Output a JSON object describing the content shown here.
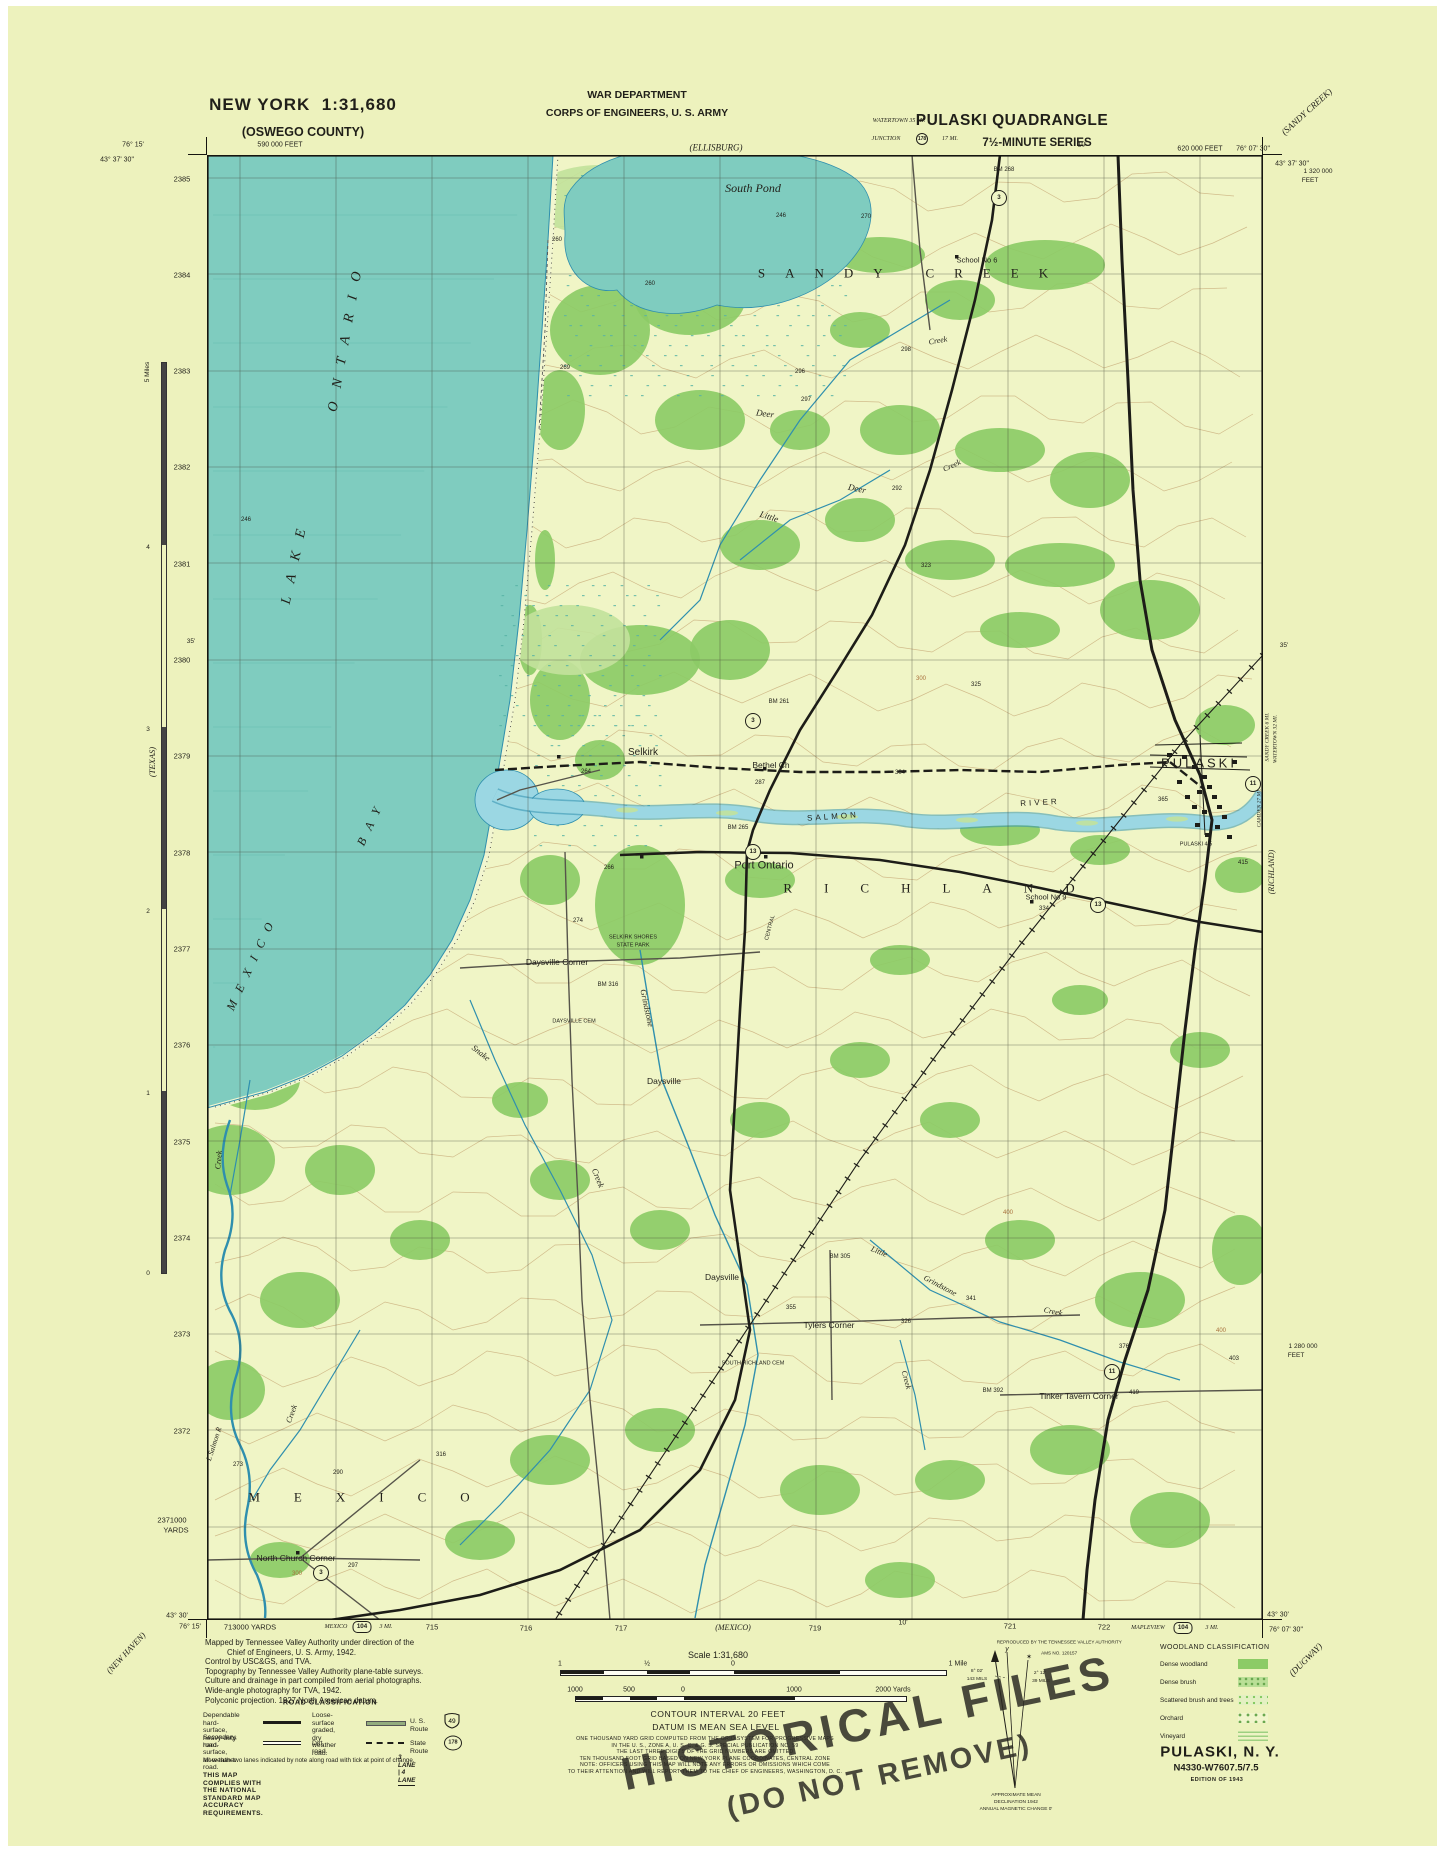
{
  "colors": {
    "paper": "#edf2bd",
    "land": "#f0f5c6",
    "lake": "#7fccbf",
    "water_line": "#2f8fae",
    "river": "#9bd7e3",
    "woodland": "#8ccb66",
    "woodland_light": "#c2e29b",
    "contour": "#a8703c",
    "road": "#1d1d18",
    "secondary_road": "#56544a",
    "grid": "#3c3c30",
    "text": "#201f19",
    "stamp": "#2a2821"
  },
  "header": {
    "state_scale": "NEW YORK  1:31,680",
    "county": "(OSWEGO COUNTY)",
    "dept1": "WAR DEPARTMENT",
    "dept2": "CORPS OF ENGINEERS, U. S. ARMY",
    "quad": "PULASKI QUADRANGLE",
    "series": "7½-MINUTE SERIES"
  },
  "credits": {
    "lines": [
      "Mapped by Tennessee Valley Authority under direction of the",
      "Chief of Engineers, U. S. Army, 1942.",
      "Control by USC&GS, and TVA.",
      "Topography by Tennessee Valley Authority plane-table surveys.",
      "Culture and drainage in part compiled from aerial photographs.",
      "Wide-angle photography for TVA, 1942.",
      "Polyconic projection. 1927 North American datum."
    ]
  },
  "road_class": {
    "title": "ROAD CLASSIFICATION",
    "r1a": "Dependable hard-surface,",
    "r1b": "heavy-duty road.",
    "r2a": "Loose-surface graded,",
    "r2b": "dry weather road.",
    "us_route": "U. S. Route",
    "us_num": "49",
    "r3a": "Secondary, hard-surface,",
    "r3b": "all-weather road.",
    "dirt": "Dirt road.",
    "state_route": "State Route",
    "state_num": "178",
    "note": "More than two lanes indicated by note along road with tick at point of change.",
    "lanes": "3 LANE | 4 LANE",
    "accuracy": "THIS MAP COMPLIES WITH THE NATIONAL STANDARD MAP ACCURACY REQUIREMENTS."
  },
  "scale_block": {
    "scale_label": "Scale 1:31,680",
    "mile_labels": [
      "1",
      "½",
      "0",
      "1 Mile"
    ],
    "yard_labels": [
      "1000",
      "500",
      "0",
      "1000",
      "2000 Yards"
    ],
    "contour": "CONTOUR INTERVAL 20 FEET",
    "datum": "DATUM IS MEAN SEA LEVEL",
    "fine": [
      "ONE THOUSAND YARD GRID COMPUTED FROM THE GRID SYSTEM FOR PROGRESSIVE MAPS",
      "IN THE U. S., ZONE A, U. S. C. & G. S. SPECIAL PUBLICATION NO. 59",
      "THE LAST THREE DIGITS OF THE GRID NUMBERS ARE OMITTED",
      "TEN THOUSAND FOOT GRID BASED ON NEW YORK PLANE COORDINATES, CENTRAL ZONE",
      "NOTE: OFFICERS USING THIS MAP WILL NOTE ANY ERRORS OR OMISSIONS WHICH COME",
      "TO THEIR ATTENTION AND WILL REPORT THEM TO THE CHIEF OF ENGINEERS, WASHINGTON, D. C."
    ]
  },
  "repro": {
    "l1": "REPRODUCED BY THE TENNESSEE VALLEY AUTHORITY",
    "l2": "AMS NO. 120157"
  },
  "declination": {
    "y": "y",
    "star": "✶",
    "left_deg": "8° 02'",
    "left_mils": "143 MILS",
    "right_deg": "2° 12'",
    "right_mils": "39 MILS",
    "note1": "APPROXIMATE MEAN",
    "note2": "DECLINATION 1942",
    "note3": "ANNUAL MAGNETIC CHANGE 0'"
  },
  "woodland": {
    "title": "WOODLAND CLASSIFICATION",
    "items": [
      {
        "label": "Dense woodland",
        "swatch": "dense"
      },
      {
        "label": "Dense brush",
        "swatch": "brush"
      },
      {
        "label": "Scattered brush and trees",
        "swatch": "scattered"
      },
      {
        "label": "Orchard",
        "swatch": "orchard"
      },
      {
        "label": "Vineyard",
        "swatch": "vineyard"
      }
    ]
  },
  "edition": {
    "title": "PULASKI, N. Y.",
    "code": "N4330-W7607.5/7.5",
    "ed": "EDITION OF 1943"
  },
  "stamp": {
    "l1": "HISTORICAL FILES",
    "l2": "(DO NOT REMOVE)"
  },
  "grid": {
    "xs": [
      240,
      336,
      432,
      528,
      624,
      720,
      816,
      912,
      1008,
      1104,
      1200
    ],
    "ys": [
      178,
      274,
      371,
      467,
      563,
      660,
      756,
      852,
      949,
      1045,
      1141,
      1238,
      1334,
      1430,
      1527
    ]
  },
  "route_shields": [
    {
      "n": "3",
      "x": 999,
      "y": 198
    },
    {
      "n": "3",
      "x": 753,
      "y": 721
    },
    {
      "n": "3",
      "x": 321,
      "y": 1573
    },
    {
      "n": "11",
      "x": 1253,
      "y": 784
    },
    {
      "n": "11",
      "x": 1112,
      "y": 1372
    },
    {
      "n": "13",
      "x": 753,
      "y": 852
    },
    {
      "n": "13",
      "x": 1098,
      "y": 905
    },
    {
      "n": "178",
      "x": 922,
      "y": 139,
      "sm": 1
    },
    {
      "n": "104",
      "x": 362,
      "y": 1627,
      "k": "b"
    },
    {
      "n": "104",
      "x": 1183,
      "y": 1628,
      "k": "b"
    }
  ],
  "map_labels": [
    {
      "t": "43° 37' 30\"",
      "x": 117,
      "y": 160,
      "s": 7
    },
    {
      "t": "76° 15'",
      "x": 133,
      "y": 145,
      "s": 7
    },
    {
      "t": "590 000 FEET",
      "x": 280,
      "y": 145,
      "s": 7
    },
    {
      "t": "(ELLISBURG)",
      "x": 716,
      "y": 148,
      "s": 9,
      "c": "i"
    },
    {
      "t": "10'",
      "x": 1082,
      "y": 145,
      "s": 7
    },
    {
      "t": "WATERTOWN 35 MI.",
      "x": 899,
      "y": 121,
      "s": 6,
      "c": "i"
    },
    {
      "t": "JUNCTION",
      "x": 886,
      "y": 139,
      "s": 6,
      "c": "i"
    },
    {
      "t": "17 MI.",
      "x": 950,
      "y": 139,
      "s": 6,
      "c": "i"
    },
    {
      "t": "620 000 FEET",
      "x": 1200,
      "y": 149,
      "s": 7
    },
    {
      "t": "76° 07' 30\"",
      "x": 1253,
      "y": 149,
      "s": 7
    },
    {
      "t": "43° 37' 30\"",
      "x": 1292,
      "y": 164,
      "s": 7
    },
    {
      "t": "(SANDY CREEK)",
      "x": 1307,
      "y": 112,
      "s": 9,
      "c": "i",
      "r": -42
    },
    {
      "t": "1 320 000",
      "x": 1318,
      "y": 172,
      "s": 6.5
    },
    {
      "t": "FEET",
      "x": 1310,
      "y": 181,
      "s": 6.5
    },
    {
      "t": "2385",
      "x": 182,
      "y": 179,
      "s": 7.5
    },
    {
      "t": "2384",
      "x": 182,
      "y": 275,
      "s": 7.5
    },
    {
      "t": "2383",
      "x": 182,
      "y": 371,
      "s": 7.5
    },
    {
      "t": "2382",
      "x": 182,
      "y": 467,
      "s": 7.5
    },
    {
      "t": "2381",
      "x": 182,
      "y": 564,
      "s": 7.5
    },
    {
      "t": "2380",
      "x": 182,
      "y": 660,
      "s": 7.5
    },
    {
      "t": "2379",
      "x": 182,
      "y": 756,
      "s": 7.5
    },
    {
      "t": "2378",
      "x": 182,
      "y": 853,
      "s": 7.5
    },
    {
      "t": "2377",
      "x": 182,
      "y": 949,
      "s": 7.5
    },
    {
      "t": "2376",
      "x": 182,
      "y": 1045,
      "s": 7.5
    },
    {
      "t": "2375",
      "x": 182,
      "y": 1142,
      "s": 7.5
    },
    {
      "t": "2374",
      "x": 182,
      "y": 1238,
      "s": 7.5
    },
    {
      "t": "2373",
      "x": 182,
      "y": 1334,
      "s": 7.5
    },
    {
      "t": "2372",
      "x": 182,
      "y": 1431,
      "s": 7.5
    },
    {
      "t": "2371000",
      "x": 172,
      "y": 1520,
      "s": 7.5
    },
    {
      "t": "YARDS",
      "x": 176,
      "y": 1530,
      "s": 7.5
    },
    {
      "t": "35'",
      "x": 191,
      "y": 642,
      "s": 6.5
    },
    {
      "t": "35'",
      "x": 1284,
      "y": 646,
      "s": 6.5
    },
    {
      "t": "1 280 000",
      "x": 1303,
      "y": 1347,
      "s": 6.5
    },
    {
      "t": "FEET",
      "x": 1296,
      "y": 1356,
      "s": 6.5
    },
    {
      "t": "5 Miles",
      "x": 148,
      "y": 372,
      "s": 6.5,
      "r": -90
    },
    {
      "t": "4",
      "x": 148,
      "y": 548,
      "s": 6.5
    },
    {
      "t": "3",
      "x": 148,
      "y": 730,
      "s": 6.5
    },
    {
      "t": "2",
      "x": 148,
      "y": 912,
      "s": 6.5
    },
    {
      "t": "1",
      "x": 148,
      "y": 1094,
      "s": 6.5
    },
    {
      "t": "0",
      "x": 148,
      "y": 1274,
      "s": 6.5
    },
    {
      "t": "(TEXAS)",
      "x": 152,
      "y": 762,
      "s": 8.5,
      "c": "i",
      "r": -90
    },
    {
      "t": "(NEW HAVEN)",
      "x": 126,
      "y": 1653,
      "s": 8.5,
      "c": "i",
      "r": -47
    },
    {
      "t": "SANDY CREEK 6 MI.",
      "x": 1268,
      "y": 737,
      "s": 5.5,
      "c": "i",
      "r": -90
    },
    {
      "t": "WATERTOWN 32 MI.",
      "x": 1276,
      "y": 739,
      "s": 5.5,
      "c": "i",
      "r": -90
    },
    {
      "t": "CAMDEN 27 MI.",
      "x": 1260,
      "y": 808,
      "s": 5.5,
      "c": "i",
      "r": -90
    },
    {
      "t": "(RICHLAND)",
      "x": 1272,
      "y": 872,
      "s": 8,
      "c": "i",
      "r": -90
    },
    {
      "t": "43° 30'",
      "x": 177,
      "y": 1616,
      "s": 7
    },
    {
      "t": "76° 15'",
      "x": 190,
      "y": 1627,
      "s": 7
    },
    {
      "t": "713000 YARDS",
      "x": 250,
      "y": 1627,
      "s": 7.5
    },
    {
      "t": "MEXICO",
      "x": 336,
      "y": 1627,
      "s": 6,
      "c": "i"
    },
    {
      "t": "3 MI.",
      "x": 386,
      "y": 1627,
      "s": 6,
      "c": "i"
    },
    {
      "t": "715",
      "x": 432,
      "y": 1627,
      "s": 7.5
    },
    {
      "t": "716",
      "x": 526,
      "y": 1628,
      "s": 7.5
    },
    {
      "t": "717",
      "x": 621,
      "y": 1628,
      "s": 7.5
    },
    {
      "t": "(MEXICO)",
      "x": 733,
      "y": 1628,
      "s": 8,
      "c": "i"
    },
    {
      "t": "719",
      "x": 815,
      "y": 1628,
      "s": 7.5
    },
    {
      "t": "10'",
      "x": 903,
      "y": 1623,
      "s": 7
    },
    {
      "t": "721",
      "x": 1010,
      "y": 1626,
      "s": 7.5
    },
    {
      "t": "722",
      "x": 1104,
      "y": 1627,
      "s": 7.5
    },
    {
      "t": "MAPLEVIEW",
      "x": 1148,
      "y": 1628,
      "s": 6,
      "c": "i"
    },
    {
      "t": "3 MI.",
      "x": 1212,
      "y": 1628,
      "s": 6,
      "c": "i"
    },
    {
      "t": "43° 30'",
      "x": 1278,
      "y": 1615,
      "s": 7
    },
    {
      "t": "76° 07' 30\"",
      "x": 1286,
      "y": 1630,
      "s": 7
    },
    {
      "t": "(DUGWAY)",
      "x": 1306,
      "y": 1660,
      "s": 9,
      "c": "i",
      "r": -45
    },
    {
      "t": "South Pond",
      "x": 753,
      "y": 188,
      "s": 12,
      "c": "i"
    },
    {
      "t": "246",
      "x": 781,
      "y": 216,
      "s": 6
    },
    {
      "t": "270",
      "x": 866,
      "y": 217,
      "s": 6
    },
    {
      "t": "260",
      "x": 650,
      "y": 284,
      "s": 6
    },
    {
      "t": "BM 268",
      "x": 1004,
      "y": 170,
      "s": 6
    },
    {
      "t": "SANDY CREEK",
      "x": 913,
      "y": 273,
      "s": 13,
      "c": "ser",
      "ls": 20
    },
    {
      "t": "School No 6",
      "x": 977,
      "y": 260,
      "s": 7.5
    },
    {
      "t": "Creek",
      "x": 938,
      "y": 341,
      "s": 8,
      "c": "i",
      "r": -10
    },
    {
      "t": "298",
      "x": 906,
      "y": 350,
      "s": 6
    },
    {
      "t": "Deer",
      "x": 765,
      "y": 414,
      "s": 9,
      "c": "i",
      "r": 8
    },
    {
      "t": "296",
      "x": 800,
      "y": 372,
      "s": 6
    },
    {
      "t": "Creek",
      "x": 952,
      "y": 466,
      "s": 8,
      "c": "i",
      "r": -25
    },
    {
      "t": "Deer",
      "x": 857,
      "y": 489,
      "s": 9,
      "c": "i",
      "r": 12
    },
    {
      "t": "297",
      "x": 806,
      "y": 400,
      "s": 6
    },
    {
      "t": "Little",
      "x": 769,
      "y": 517,
      "s": 9,
      "c": "i",
      "r": 18
    },
    {
      "t": "292",
      "x": 897,
      "y": 489,
      "s": 6
    },
    {
      "t": "323",
      "x": 926,
      "y": 566,
      "s": 6
    },
    {
      "t": "246",
      "x": 246,
      "y": 520,
      "s": 6
    },
    {
      "t": "269",
      "x": 565,
      "y": 368,
      "s": 6
    },
    {
      "t": "260",
      "x": 557,
      "y": 240,
      "s": 6
    },
    {
      "t": "LAKE",
      "x": 296,
      "y": 560,
      "s": 14,
      "c": "i",
      "r": -78,
      "ls": 14
    },
    {
      "t": "ONTARIO",
      "x": 347,
      "y": 335,
      "s": 14,
      "c": "i",
      "r": -80,
      "ls": 14
    },
    {
      "t": "MEXICO",
      "x": 252,
      "y": 962,
      "s": 12,
      "c": "i",
      "r": -65,
      "ls": 10
    },
    {
      "t": "BAY",
      "x": 371,
      "y": 822,
      "s": 12,
      "c": "i",
      "r": -65,
      "ls": 10
    },
    {
      "t": "BM 261",
      "x": 779,
      "y": 702,
      "s": 6
    },
    {
      "t": "Selkirk",
      "x": 643,
      "y": 753,
      "s": 10
    },
    {
      "t": "264",
      "x": 586,
      "y": 772,
      "s": 6
    },
    {
      "t": "Bethel Ch",
      "x": 771,
      "y": 765,
      "s": 8.5
    },
    {
      "t": "287",
      "x": 760,
      "y": 783,
      "s": 6
    },
    {
      "t": "304",
      "x": 900,
      "y": 773,
      "s": 6
    },
    {
      "t": "325",
      "x": 976,
      "y": 685,
      "s": 6
    },
    {
      "t": "300",
      "x": 921,
      "y": 679,
      "s": 6,
      "c": "br"
    },
    {
      "t": "SALMON",
      "x": 833,
      "y": 817,
      "s": 8,
      "ls": 3,
      "r": -4
    },
    {
      "t": "RIVER",
      "x": 1040,
      "y": 803,
      "s": 8,
      "ls": 3,
      "r": -3
    },
    {
      "t": "365",
      "x": 1163,
      "y": 800,
      "s": 6
    },
    {
      "t": "PULASKI",
      "x": 1199,
      "y": 763,
      "s": 13,
      "ls": 3
    },
    {
      "t": "PULASKI 4.5",
      "x": 1196,
      "y": 845,
      "s": 5.5
    },
    {
      "t": "415",
      "x": 1243,
      "y": 863,
      "s": 6
    },
    {
      "t": "Port Ontario",
      "x": 764,
      "y": 866,
      "s": 11
    },
    {
      "t": "BM 265",
      "x": 738,
      "y": 828,
      "s": 6
    },
    {
      "t": "266",
      "x": 609,
      "y": 868,
      "s": 6
    },
    {
      "t": "School No 9",
      "x": 1046,
      "y": 897,
      "s": 7.5
    },
    {
      "t": "334",
      "x": 1044,
      "y": 909,
      "s": 6
    },
    {
      "t": "SELKIRK SHORES",
      "x": 633,
      "y": 938,
      "s": 5.5
    },
    {
      "t": "STATE PARK",
      "x": 633,
      "y": 946,
      "s": 5.5
    },
    {
      "t": "BM 316",
      "x": 608,
      "y": 985,
      "s": 6
    },
    {
      "t": "RICHLAND",
      "x": 945,
      "y": 888,
      "s": 13,
      "c": "ser",
      "ls": 32
    },
    {
      "t": "CENTRAL",
      "x": 771,
      "y": 928,
      "s": 5.5,
      "r": -75
    },
    {
      "t": "274",
      "x": 578,
      "y": 921,
      "s": 6
    },
    {
      "t": "Daysville Corner",
      "x": 557,
      "y": 962,
      "s": 8.5
    },
    {
      "t": "DAYSVILLE CEM",
      "x": 574,
      "y": 1022,
      "s": 5.5
    },
    {
      "t": "Grindstone",
      "x": 647,
      "y": 1008,
      "s": 8.5,
      "c": "i",
      "r": 78
    },
    {
      "t": "Snake",
      "x": 481,
      "y": 1053,
      "s": 8.5,
      "c": "i",
      "r": 38
    },
    {
      "t": "Creek",
      "x": 598,
      "y": 1178,
      "s": 8.5,
      "c": "i",
      "r": 68
    },
    {
      "t": "Daysville",
      "x": 664,
      "y": 1081,
      "s": 8.5
    },
    {
      "t": "Little",
      "x": 879,
      "y": 1252,
      "s": 8,
      "c": "i",
      "r": 22
    },
    {
      "t": "Grindstone",
      "x": 940,
      "y": 1286,
      "s": 8,
      "c": "i",
      "r": 28
    },
    {
      "t": "Creek",
      "x": 1053,
      "y": 1312,
      "s": 8,
      "c": "i",
      "r": 12
    },
    {
      "t": "BM 305",
      "x": 840,
      "y": 1257,
      "s": 6
    },
    {
      "t": "Daysville",
      "x": 722,
      "y": 1277,
      "s": 8.5
    },
    {
      "t": "326",
      "x": 906,
      "y": 1322,
      "s": 6
    },
    {
      "t": "341",
      "x": 971,
      "y": 1299,
      "s": 6
    },
    {
      "t": "376",
      "x": 1124,
      "y": 1347,
      "s": 6
    },
    {
      "t": "400",
      "x": 1008,
      "y": 1213,
      "s": 6,
      "c": "br"
    },
    {
      "t": "400",
      "x": 1221,
      "y": 1331,
      "s": 6,
      "c": "br"
    },
    {
      "t": "403",
      "x": 1234,
      "y": 1359,
      "s": 6
    },
    {
      "t": "355",
      "x": 791,
      "y": 1308,
      "s": 6
    },
    {
      "t": "Tylers Corner",
      "x": 829,
      "y": 1325,
      "s": 8.5
    },
    {
      "t": "SOUTH RICHLAND CEM",
      "x": 753,
      "y": 1364,
      "s": 5.5
    },
    {
      "t": "Creek",
      "x": 906,
      "y": 1380,
      "s": 8,
      "c": "i",
      "r": 75
    },
    {
      "t": "Tinker Tavern Corner",
      "x": 1079,
      "y": 1396,
      "s": 8.5
    },
    {
      "t": "419",
      "x": 1134,
      "y": 1393,
      "s": 6
    },
    {
      "t": "BM 392",
      "x": 993,
      "y": 1391,
      "s": 6
    },
    {
      "t": "MEXICO",
      "x": 376,
      "y": 1497,
      "s": 13,
      "c": "ser",
      "ls": 34
    },
    {
      "t": "North Church Corner",
      "x": 296,
      "y": 1558,
      "s": 8.5
    },
    {
      "t": "297",
      "x": 353,
      "y": 1566,
      "s": 6
    },
    {
      "t": "300",
      "x": 297,
      "y": 1574,
      "s": 6,
      "c": "br"
    },
    {
      "t": "L Salmon R",
      "x": 214,
      "y": 1444,
      "s": 7.5,
      "c": "i",
      "r": -72
    },
    {
      "t": "Creek",
      "x": 292,
      "y": 1414,
      "s": 8,
      "c": "i",
      "r": -70
    },
    {
      "t": "Creek",
      "x": 219,
      "y": 1160,
      "s": 8,
      "c": "i",
      "r": -85
    },
    {
      "t": "273",
      "x": 238,
      "y": 1465,
      "s": 6
    },
    {
      "t": "290",
      "x": 338,
      "y": 1473,
      "s": 6
    },
    {
      "t": "316",
      "x": 441,
      "y": 1455,
      "s": 6
    }
  ]
}
